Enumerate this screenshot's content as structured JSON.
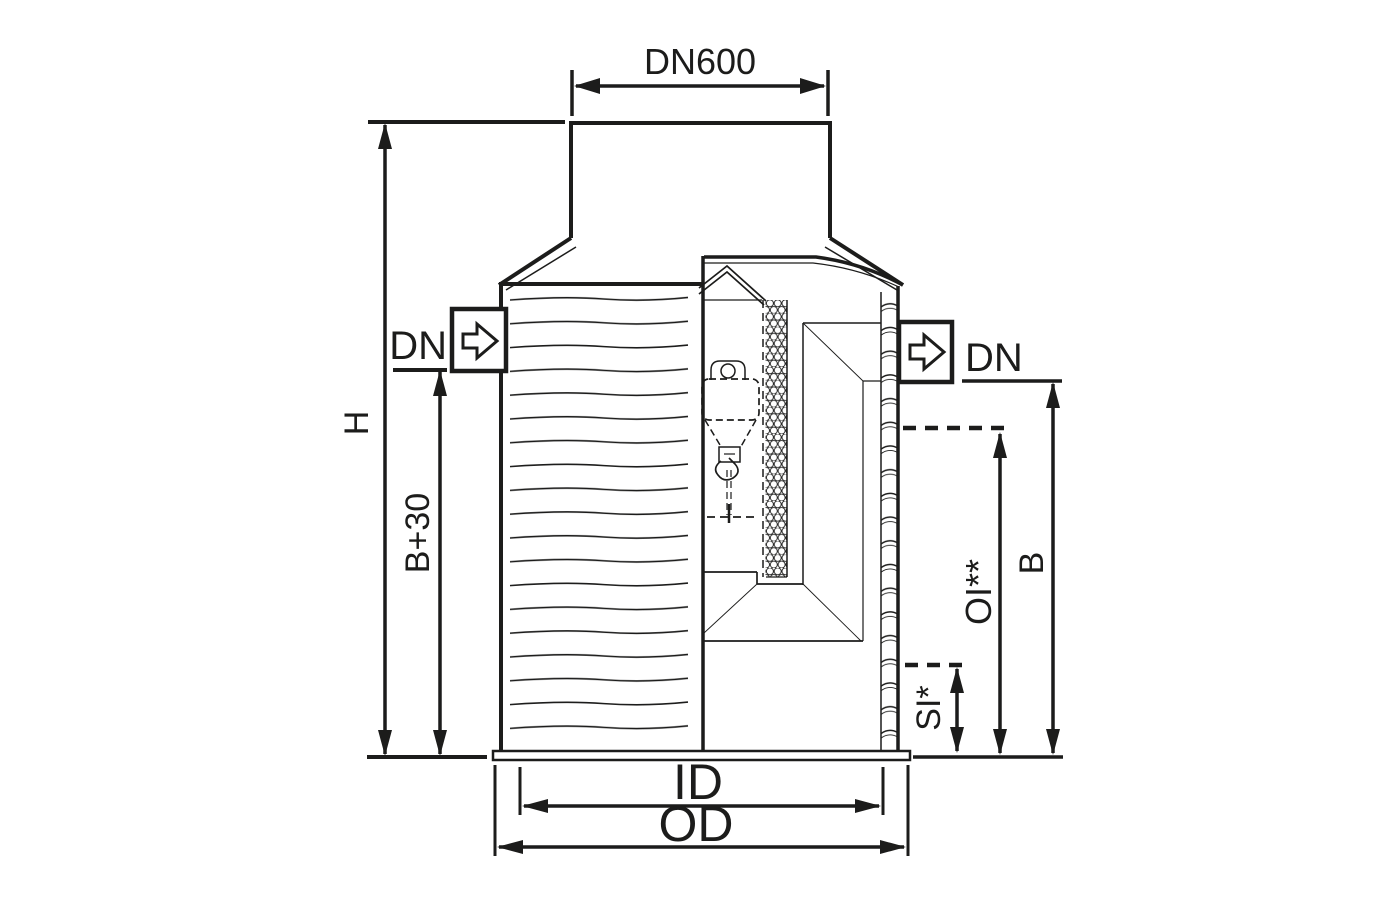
{
  "labels": {
    "neck_diameter": "DN600",
    "inlet_nominal": "DN",
    "outlet_nominal": "DN",
    "total_height": "H",
    "inlet_depth": "B+30",
    "outlet_depth": "B",
    "oil_layer": "OI**",
    "sludge_layer": "SI*",
    "inner_diameter": "ID",
    "outer_diameter": "OD"
  },
  "colors": {
    "line": "#1c1c1b",
    "background": "#ffffff"
  }
}
